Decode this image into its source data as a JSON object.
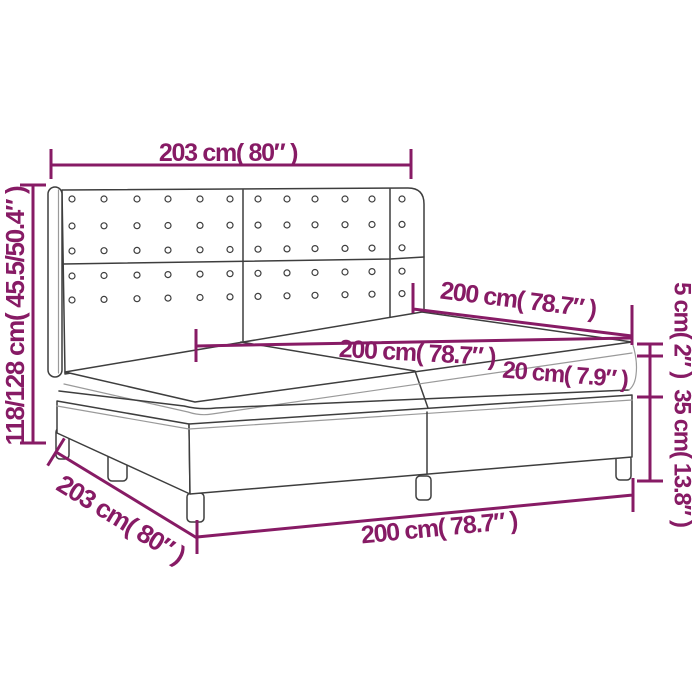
{
  "diagram": {
    "title": "Box spring bed dimension diagram",
    "colors": {
      "annotation": "#871b65",
      "outline": "#3e3e3e",
      "background": "#ffffff"
    },
    "annotations": {
      "headboard_width_top": "203 cm( 80″ )",
      "total_height_left": "118/128 cm( 45.5/50.4″ )",
      "bed_length_upper": "200 cm( 78.7″ )",
      "mattress_length": "200 cm( 78.7″ )",
      "mattress_height": "20 cm( 7.9″ )",
      "topper_height": "5 cm( 2″ )",
      "base_height": "35 cm( 13.8″ )",
      "bed_length_bottom": "200 cm( 78.7″ )",
      "bed_width_bottom": "203 cm( 80″ )"
    }
  }
}
